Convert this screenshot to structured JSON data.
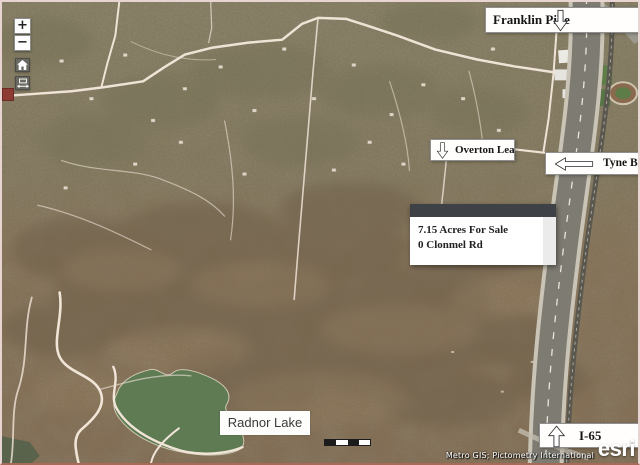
{
  "controls": {
    "zoom_in": "+",
    "zoom_out": "−"
  },
  "annotations": {
    "franklin_pike": "Franklin Pike",
    "overton_lea": "Overton Lea",
    "tyne_blvd": "Tyne Blvd",
    "i65": "I-65",
    "radnor_lake": "Radnor Lake"
  },
  "callout": {
    "line1": "7.15 Acres For Sale",
    "line2": "0 Clonmel Rd"
  },
  "attribution": {
    "sources": "Metro GIS; Pictometry International",
    "logo": "esri"
  },
  "colors": {
    "terrain_top": "#8e8a6b",
    "terrain_bottom": "#8d7457",
    "lake": "#5e7b53",
    "road": "#efe3d6",
    "highway": "#7e7c72",
    "callout_header": "#3e4246",
    "label_background": "#fffefc"
  }
}
